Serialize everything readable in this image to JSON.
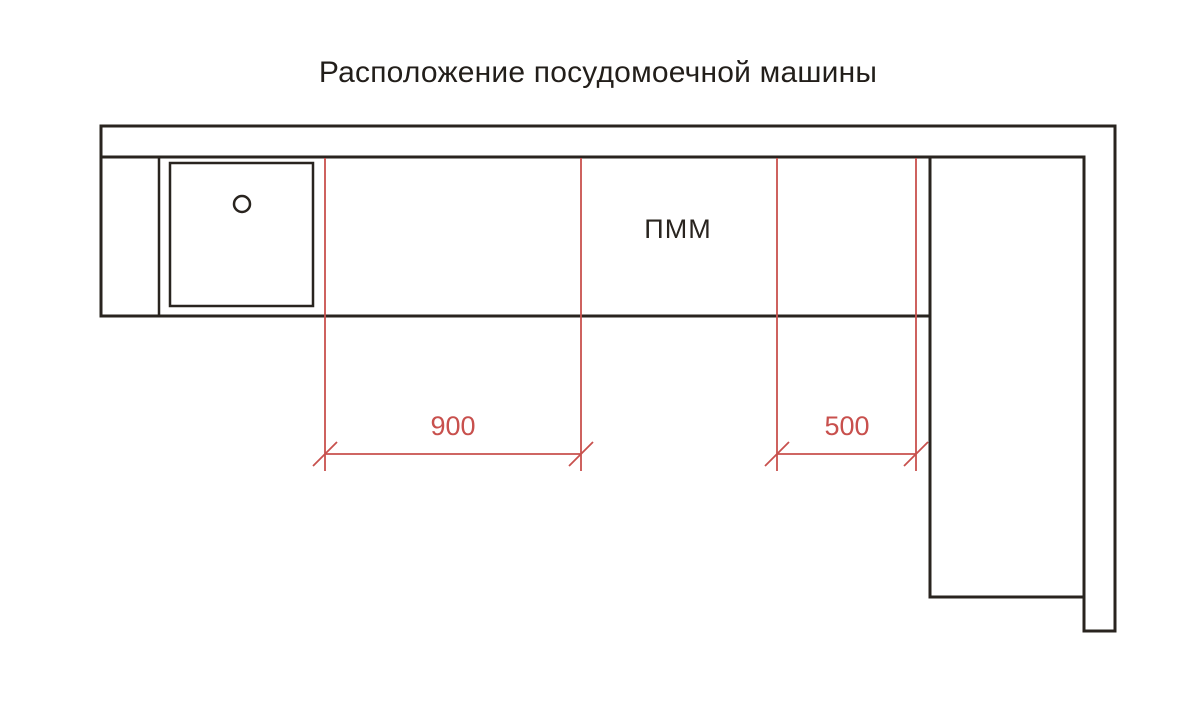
{
  "title": "Расположение посудомоечной машины",
  "drawing": {
    "dishwasher_label": "ПММ",
    "dimensions": [
      {
        "label": "900"
      },
      {
        "label": "500"
      }
    ],
    "colors": {
      "line": "#29241f",
      "dimension": "#c8504d",
      "text": "#221e1a",
      "background": "#ffffff"
    }
  }
}
